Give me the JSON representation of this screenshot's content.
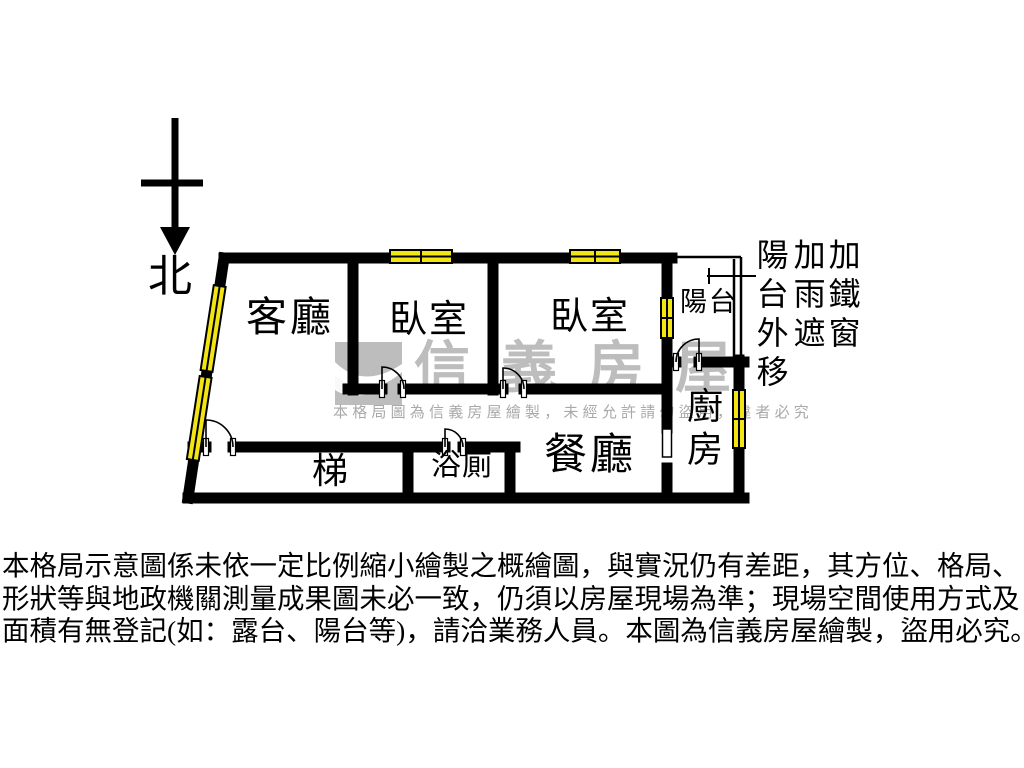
{
  "canvas": {
    "width": 1024,
    "height": 768,
    "background": "#ffffff"
  },
  "colors": {
    "wall": "#000000",
    "window_fill": "#f3e514",
    "watermark_gray": "#bdbdbd",
    "watermark_notice_gray": "#a9a9a9",
    "text": "#000000"
  },
  "compass": {
    "north_label": "北"
  },
  "rooms": {
    "living": "客廳",
    "bedroom1": "臥室",
    "bedroom2": "臥室",
    "balcony": "陽台",
    "kitchen": "廚房",
    "dining": "餐廳",
    "bathroom": "浴廁",
    "stairs": "梯"
  },
  "annotations": {
    "col1": "陽台外移",
    "col2": "加雨遮",
    "col3": "加鐵窗"
  },
  "watermark": {
    "brand": "信義房屋",
    "notice": "本格局圖為信義房屋繪製，未經允許請勿盜用，違者必究"
  },
  "disclaimer": {
    "line1": "本格局示意圖係未依一定比例縮小繪製之概繪圖，與實況仍有差距，其方位、格局、",
    "line2": "形狀等與地政機關測量成果圖未必一致，仍須以房屋現場為準；現場空間使用方式及",
    "line3": "面積有無登記(如：露台、陽台等)，請洽業務人員。本圖為信義房屋繪製，盜用必究。"
  }
}
